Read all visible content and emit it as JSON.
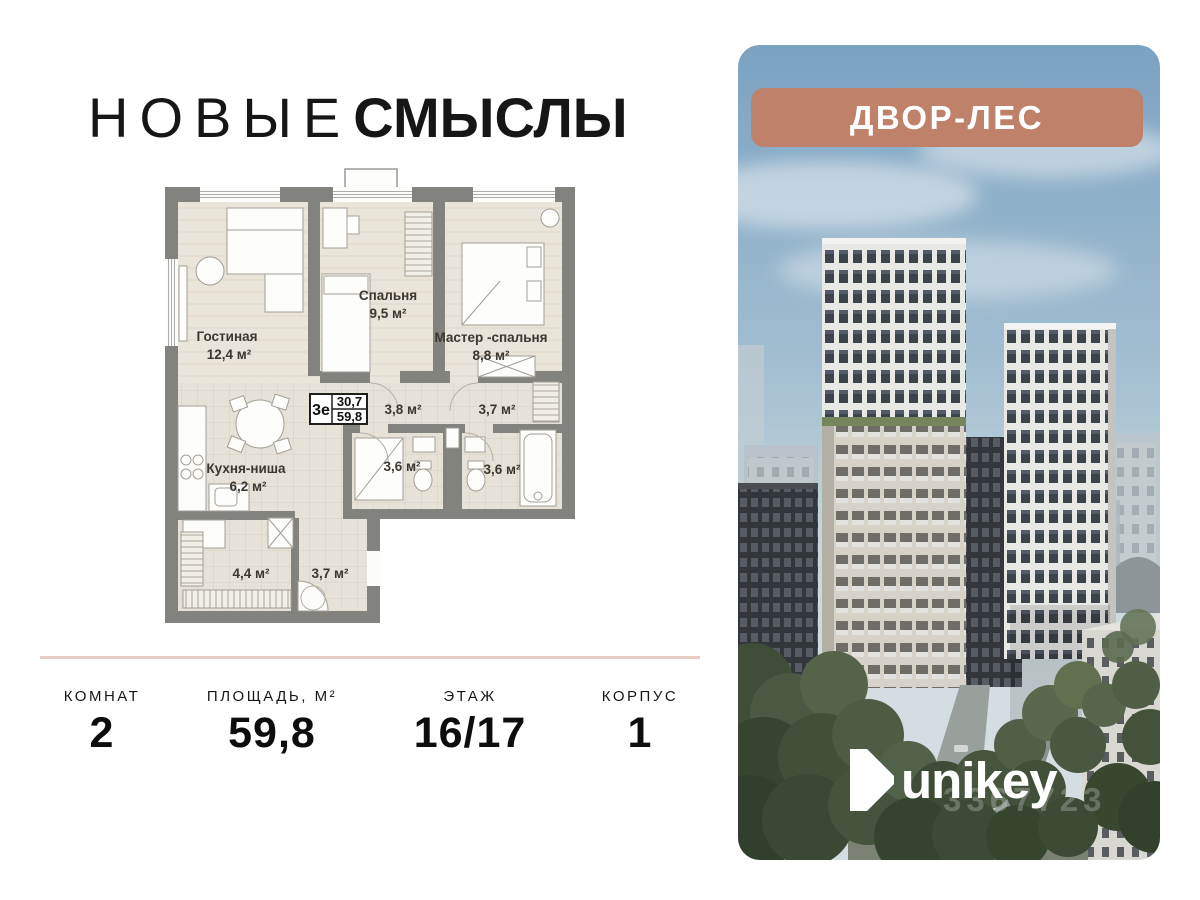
{
  "brand": {
    "title_light": "НОВЫЕ",
    "title_bold": "СМЫСЛЫ"
  },
  "plan": {
    "spec_type": "3е",
    "spec_living": "30,7",
    "spec_total": "59,8",
    "rooms": {
      "living": {
        "name": "Гостиная",
        "area": "12,4 м²"
      },
      "bedroom": {
        "name": "Спальня",
        "area": "9,5 м²"
      },
      "master": {
        "name": "Мастер -спальня",
        "area": "8,8 м²"
      },
      "hall": {
        "area": "3,8 м²"
      },
      "wardrobe_top": {
        "area": "3,7 м²"
      },
      "kitchen": {
        "name": "Кухня-ниша",
        "area": "6,2 м²"
      },
      "bath1": {
        "area": "3,6 м²"
      },
      "bath2": {
        "area": "3,6 м²"
      },
      "closet": {
        "area": "4,4 м²"
      },
      "hallway": {
        "area": "3,7 м²"
      }
    }
  },
  "stats": {
    "rooms": {
      "label": "КОМНАТ",
      "value": "2"
    },
    "area": {
      "label": "ПЛОЩАДЬ, М²",
      "value": "59,8"
    },
    "floor": {
      "label": "ЭТАЖ",
      "value": "16/17"
    },
    "building": {
      "label": "КОРПУС",
      "value": "1"
    }
  },
  "poster": {
    "badge_label": "ДВОР-ЛЕС",
    "logo_text": "unikey",
    "watermark": "3367723"
  },
  "colors": {
    "badge_bg": "#bf8169",
    "divider": "#e7cfc5",
    "sky_top": "#7ba2c2",
    "sky_bottom": "#d4dee2",
    "wall_gray": "#82827e"
  }
}
